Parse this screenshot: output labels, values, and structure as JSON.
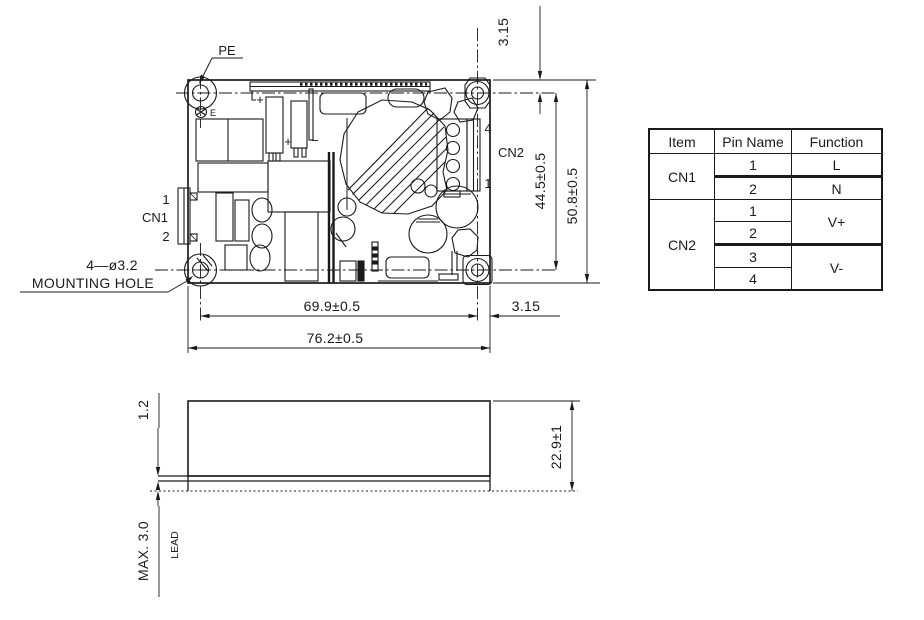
{
  "drawing": {
    "pe_label": "PE",
    "pe_terminal_label": "E",
    "cn1_label": "CN1",
    "cn1_pin_top": "1",
    "cn1_pin_bottom": "2",
    "cn2_label": "CN2",
    "cn2_pin_top": "4",
    "cn2_pin_bottom": "1",
    "mounting_note_line1": "4—ø3.2",
    "mounting_note_line2": "MOUNTING HOLE",
    "polarity_plus_1": "+",
    "polarity_plus_2": "+",
    "polarity_minus": "−",
    "dims": {
      "hole_offset_top": "3.15",
      "hole_offset_right": "3.15",
      "hole_pitch_vertical": "44.5±0.5",
      "board_height": "50.8±0.5",
      "hole_pitch_horizontal": "69.9±0.5",
      "board_width": "76.2±0.5",
      "pcb_thickness": "1.2",
      "lead_max": "MAX. 3.0",
      "lead_label": "LEAD",
      "profile_height": "22.9±1"
    }
  },
  "pin_table": {
    "header": {
      "item": "Item",
      "pin_name": "Pin Name",
      "function": "Function"
    },
    "cn1": {
      "item": "CN1",
      "pin1": "1",
      "pin2": "2",
      "fn1": "L",
      "fn2": "N"
    },
    "cn2": {
      "item": "CN2",
      "pin1": "1",
      "pin2": "2",
      "pin3": "3",
      "pin4": "4",
      "fn12": "V+",
      "fn34": "V-"
    }
  }
}
